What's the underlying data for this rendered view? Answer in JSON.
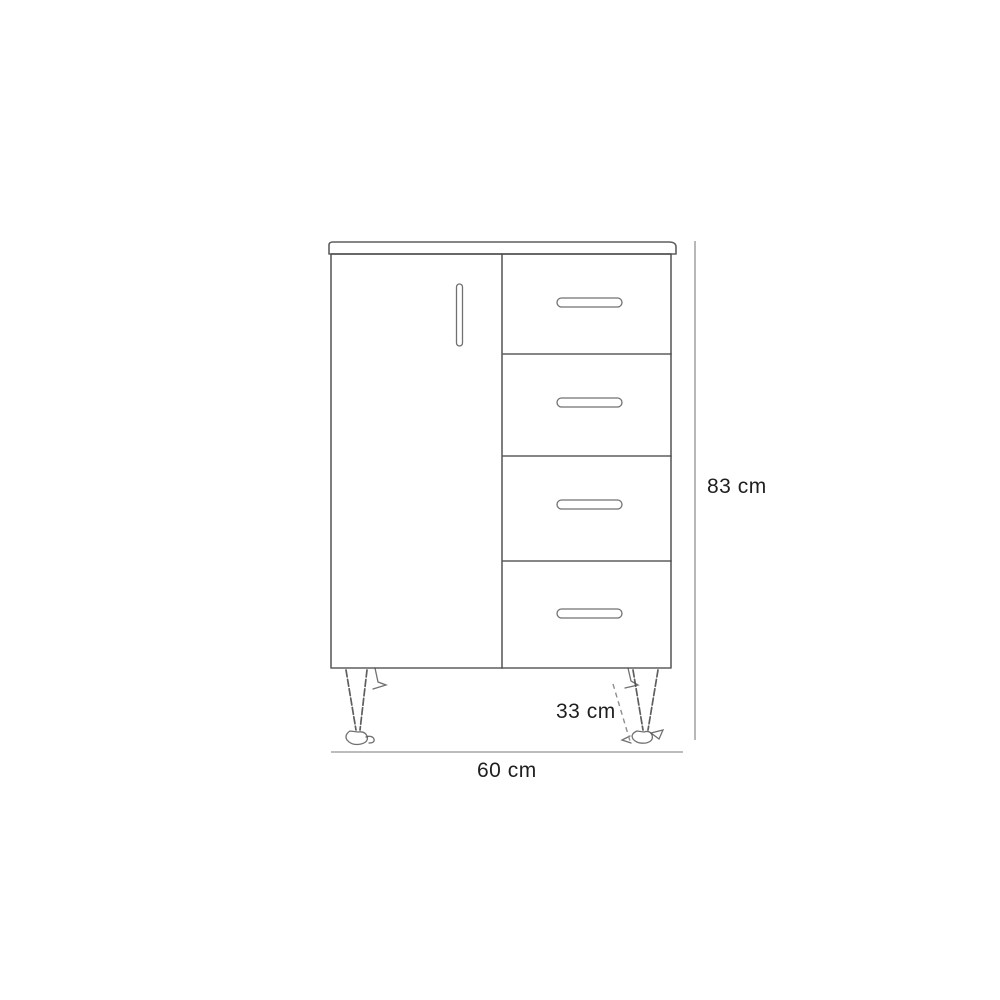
{
  "diagram": {
    "type": "furniture-dimension-line-drawing",
    "subject": "cabinet with one door and four drawers on legs",
    "labels": {
      "height": "83 cm",
      "width": "60 cm",
      "depth": "33 cm"
    },
    "structure": {
      "door_count": 1,
      "drawer_count": 4,
      "visible_leg_count": 2
    },
    "colors": {
      "background": "#ffffff",
      "sketch_line": "#4d4d4d",
      "dimension_line": "#a6a6a6",
      "dashed_line": "#8f8f8f",
      "label_text": "#1f1f1f"
    }
  }
}
